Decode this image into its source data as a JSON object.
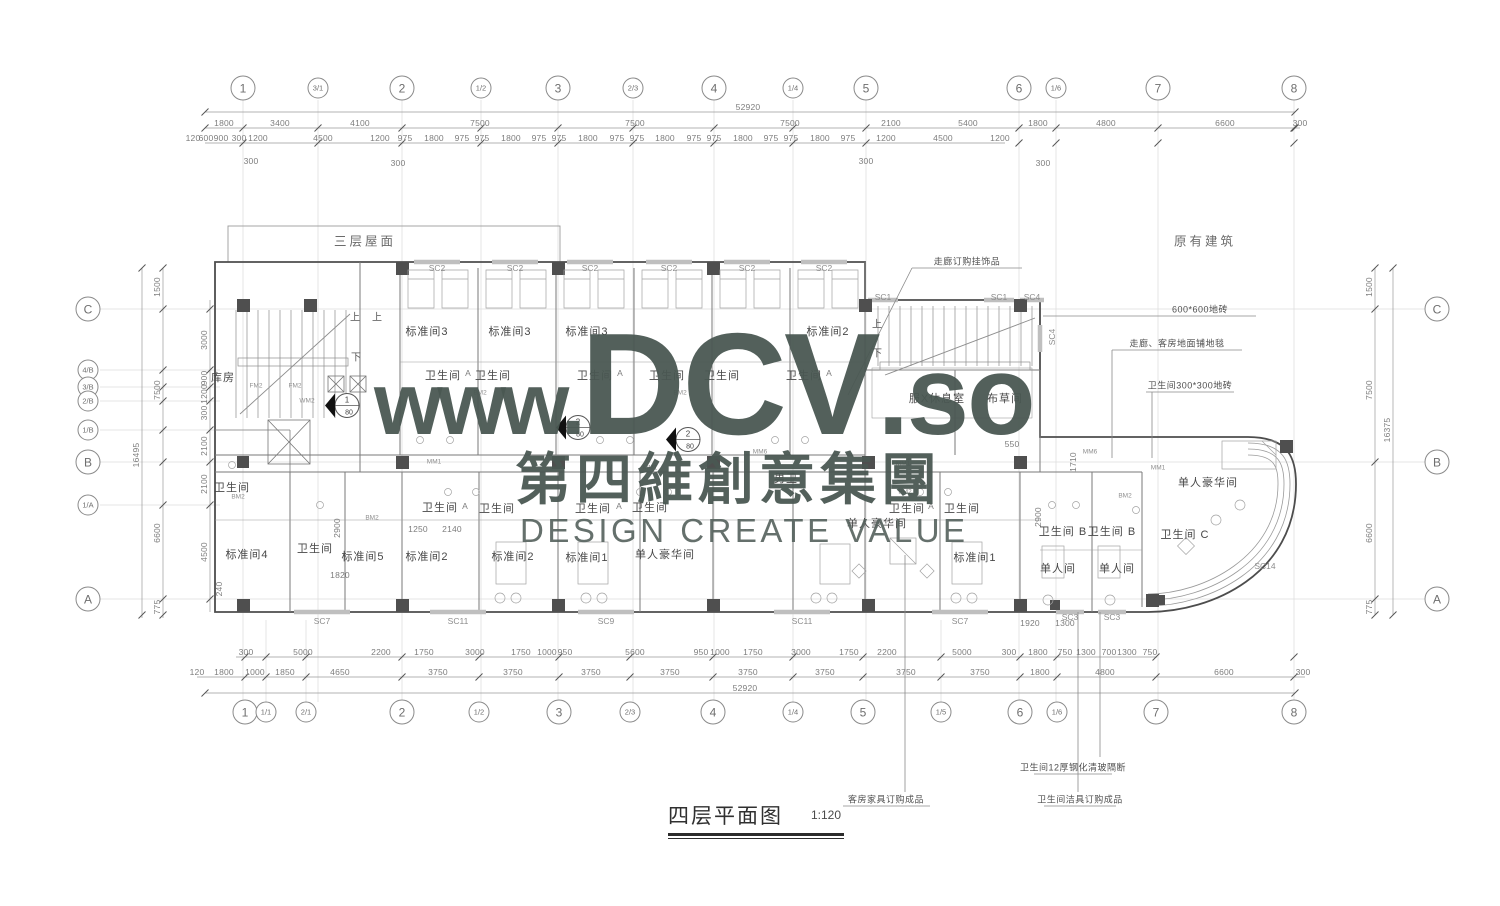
{
  "watermark": {
    "www": "www.",
    "brand": "DCV",
    "so": ".so",
    "cn": "第四維創意集團",
    "en": "DESIGN CREATE VALUE",
    "color": "#4a5752"
  },
  "title": {
    "text": "四层平面图",
    "scale": "1:120"
  },
  "grid_bubbles": {
    "top": [
      {
        "t": "1",
        "x": 243
      },
      {
        "t": "3/1",
        "x": 318
      },
      {
        "t": "2",
        "x": 402
      },
      {
        "t": "1/2",
        "x": 481
      },
      {
        "t": "3",
        "x": 558
      },
      {
        "t": "2/3",
        "x": 633
      },
      {
        "t": "4",
        "x": 714
      },
      {
        "t": "1/4",
        "x": 793
      },
      {
        "t": "5",
        "x": 866
      },
      {
        "t": "6",
        "x": 1019
      },
      {
        "t": "1/6",
        "x": 1056
      },
      {
        "t": "7",
        "x": 1158
      },
      {
        "t": "8",
        "x": 1294
      }
    ],
    "bottom": [
      {
        "t": "1",
        "x": 245
      },
      {
        "t": "1/1",
        "x": 266
      },
      {
        "t": "2/1",
        "x": 306
      },
      {
        "t": "2",
        "x": 402
      },
      {
        "t": "1/2",
        "x": 479
      },
      {
        "t": "3",
        "x": 559
      },
      {
        "t": "2/3",
        "x": 630
      },
      {
        "t": "4",
        "x": 713
      },
      {
        "t": "1/4",
        "x": 793
      },
      {
        "t": "5",
        "x": 863
      },
      {
        "t": "1/5",
        "x": 941
      },
      {
        "t": "6",
        "x": 1020
      },
      {
        "t": "1/6",
        "x": 1057
      },
      {
        "t": "7",
        "x": 1156
      },
      {
        "t": "8",
        "x": 1294
      }
    ],
    "left": [
      {
        "t": "C",
        "y": 309
      },
      {
        "t": "4/B",
        "y": 370
      },
      {
        "t": "3/B",
        "y": 387
      },
      {
        "t": "2/B",
        "y": 401
      },
      {
        "t": "1/B",
        "y": 430
      },
      {
        "t": "B",
        "y": 462
      },
      {
        "t": "1/A",
        "y": 505
      },
      {
        "t": "A",
        "y": 599
      }
    ],
    "right": [
      {
        "t": "C",
        "y": 309
      },
      {
        "t": "B",
        "y": 462
      },
      {
        "t": "A",
        "y": 599
      }
    ]
  },
  "dims": {
    "top_rows": [
      {
        "y": 107,
        "items": [
          {
            "t": "52920",
            "x": 748
          }
        ]
      },
      {
        "y": 123,
        "items": [
          {
            "t": "1800",
            "x": 224
          },
          {
            "t": "3400",
            "x": 280
          },
          {
            "t": "4100",
            "x": 360
          },
          {
            "t": "7500",
            "x": 480
          },
          {
            "t": "7500",
            "x": 635
          },
          {
            "t": "7500",
            "x": 790
          },
          {
            "t": "2100",
            "x": 891
          },
          {
            "t": "5400",
            "x": 968
          },
          {
            "t": "1800",
            "x": 1038
          },
          {
            "t": "4800",
            "x": 1106
          },
          {
            "t": "6600",
            "x": 1225
          },
          {
            "t": "300",
            "x": 1300
          }
        ]
      },
      {
        "y": 138,
        "items": [
          {
            "t": "120",
            "x": 193
          },
          {
            "t": "600",
            "x": 206
          },
          {
            "t": "900",
            "x": 221
          },
          {
            "t": "300",
            "x": 239
          },
          {
            "t": "1200",
            "x": 258
          },
          {
            "t": "4500",
            "x": 323
          },
          {
            "t": "1200",
            "x": 380
          },
          {
            "t": "975",
            "x": 405
          },
          {
            "t": "1800",
            "x": 434
          },
          {
            "t": "975",
            "x": 462
          },
          {
            "t": "975",
            "x": 482
          },
          {
            "t": "1800",
            "x": 511
          },
          {
            "t": "975",
            "x": 539
          },
          {
            "t": "975",
            "x": 559
          },
          {
            "t": "1800",
            "x": 588
          },
          {
            "t": "975",
            "x": 617
          },
          {
            "t": "975",
            "x": 637
          },
          {
            "t": "1800",
            "x": 665
          },
          {
            "t": "975",
            "x": 694
          },
          {
            "t": "975",
            "x": 714
          },
          {
            "t": "1800",
            "x": 743
          },
          {
            "t": "975",
            "x": 771
          },
          {
            "t": "975",
            "x": 791
          },
          {
            "t": "1800",
            "x": 820
          },
          {
            "t": "975",
            "x": 848
          },
          {
            "t": "1200",
            "x": 886
          },
          {
            "t": "4500",
            "x": 943
          },
          {
            "t": "1200",
            "x": 1000
          }
        ]
      }
    ],
    "top_drops": [
      {
        "t": "300",
        "x": 251,
        "y": 161
      },
      {
        "t": "300",
        "x": 398,
        "y": 163
      },
      {
        "t": "300",
        "x": 866,
        "y": 161
      },
      {
        "t": "300",
        "x": 1043,
        "y": 163
      }
    ],
    "bottom_rows": [
      {
        "y": 652,
        "items": [
          {
            "t": "300",
            "x": 246
          },
          {
            "t": "5000",
            "x": 303
          },
          {
            "t": "2200",
            "x": 381
          },
          {
            "t": "1750",
            "x": 424
          },
          {
            "t": "3000",
            "x": 475
          },
          {
            "t": "1750",
            "x": 521
          },
          {
            "t": "1000",
            "x": 547
          },
          {
            "t": "950",
            "x": 565
          },
          {
            "t": "5600",
            "x": 635
          },
          {
            "t": "950",
            "x": 701
          },
          {
            "t": "1000",
            "x": 720
          },
          {
            "t": "1750",
            "x": 753
          },
          {
            "t": "3000",
            "x": 801
          },
          {
            "t": "1750",
            "x": 849
          },
          {
            "t": "2200",
            "x": 887
          },
          {
            "t": "5000",
            "x": 962
          },
          {
            "t": "300",
            "x": 1009
          },
          {
            "t": "1800",
            "x": 1038
          },
          {
            "t": "750",
            "x": 1065
          },
          {
            "t": "1300",
            "x": 1086
          },
          {
            "t": "700",
            "x": 1109
          },
          {
            "t": "1300",
            "x": 1127
          },
          {
            "t": "750",
            "x": 1150
          }
        ]
      },
      {
        "y": 672,
        "items": [
          {
            "t": "120",
            "x": 197
          },
          {
            "t": "1800",
            "x": 224
          },
          {
            "t": "1000",
            "x": 255
          },
          {
            "t": "1850",
            "x": 285
          },
          {
            "t": "4650",
            "x": 340
          },
          {
            "t": "3750",
            "x": 438
          },
          {
            "t": "3750",
            "x": 513
          },
          {
            "t": "3750",
            "x": 591
          },
          {
            "t": "3750",
            "x": 670
          },
          {
            "t": "3750",
            "x": 748
          },
          {
            "t": "3750",
            "x": 825
          },
          {
            "t": "3750",
            "x": 906
          },
          {
            "t": "3750",
            "x": 980
          },
          {
            "t": "1800",
            "x": 1040
          },
          {
            "t": "4800",
            "x": 1105
          },
          {
            "t": "6600",
            "x": 1224
          },
          {
            "t": "300",
            "x": 1303
          }
        ]
      },
      {
        "y": 688,
        "items": [
          {
            "t": "52920",
            "x": 745
          }
        ]
      }
    ],
    "left_rows": [
      {
        "x": 136,
        "items": [
          {
            "t": "16495",
            "y": 455
          }
        ]
      },
      {
        "x": 157,
        "items": [
          {
            "t": "1500",
            "y": 287
          },
          {
            "t": "7500",
            "y": 390
          },
          {
            "t": "6600",
            "y": 533
          },
          {
            "t": "775",
            "y": 607
          }
        ]
      },
      {
        "x": 204,
        "items": [
          {
            "t": "3000",
            "y": 340
          },
          {
            "t": "900",
            "y": 378
          },
          {
            "t": "1200",
            "y": 394
          },
          {
            "t": "300",
            "y": 413
          },
          {
            "t": "2100",
            "y": 446
          },
          {
            "t": "2100",
            "y": 484
          },
          {
            "t": "4500",
            "y": 552
          }
        ]
      }
    ],
    "right_rows": [
      {
        "x": 1369,
        "items": [
          {
            "t": "1500",
            "y": 287
          },
          {
            "t": "7500",
            "y": 390
          },
          {
            "t": "6600",
            "y": 533
          },
          {
            "t": "775",
            "y": 607
          }
        ]
      },
      {
        "x": 1387,
        "items": [
          {
            "t": "16375",
            "y": 430
          }
        ]
      }
    ],
    "plan_dims": [
      {
        "t": "1820",
        "x": 340,
        "y": 575
      },
      {
        "t": "2900",
        "x": 337,
        "y": 528,
        "r": 1
      },
      {
        "t": "1250",
        "x": 418,
        "y": 529
      },
      {
        "t": "2140",
        "x": 452,
        "y": 529
      },
      {
        "t": "550",
        "x": 1012,
        "y": 444
      },
      {
        "t": "1710",
        "x": 1073,
        "y": 462,
        "r": 1
      },
      {
        "t": "2900",
        "x": 1038,
        "y": 517,
        "r": 1
      },
      {
        "t": "1920",
        "x": 1030,
        "y": 623
      },
      {
        "t": "1300",
        "x": 1065,
        "y": 623
      },
      {
        "t": "240",
        "x": 219,
        "y": 589,
        "r": 1
      }
    ]
  },
  "rooms": [
    {
      "t": "库房",
      "x": 223,
      "y": 377
    },
    {
      "t": "标准间3",
      "x": 427,
      "y": 331
    },
    {
      "t": "标准间3",
      "x": 510,
      "y": 331
    },
    {
      "t": "标准间3",
      "x": 587,
      "y": 331
    },
    {
      "t": "标准间2",
      "x": 828,
      "y": 331
    },
    {
      "t": "标准间4",
      "x": 247,
      "y": 554
    },
    {
      "t": "标准间5",
      "x": 363,
      "y": 556
    },
    {
      "t": "标准间2",
      "x": 427,
      "y": 556
    },
    {
      "t": "标准间2",
      "x": 513,
      "y": 556
    },
    {
      "t": "标准间1",
      "x": 587,
      "y": 557
    },
    {
      "t": "标准间1",
      "x": 975,
      "y": 557
    },
    {
      "t": "单人豪华间",
      "x": 665,
      "y": 554
    },
    {
      "t": "单人豪华间",
      "x": 877,
      "y": 523
    },
    {
      "t": "单人豪华间",
      "x": 1208,
      "y": 482
    },
    {
      "t": "单人间",
      "x": 1058,
      "y": 568
    },
    {
      "t": "单人间",
      "x": 1117,
      "y": 568
    },
    {
      "t": "服X休息室",
      "x": 937,
      "y": 398
    },
    {
      "t": "布草间",
      "x": 1005,
      "y": 398
    },
    {
      "t": "男卫",
      "x": 786,
      "y": 478
    }
  ],
  "bathrooms": [
    {
      "t": "卫生间",
      "x": 232,
      "y": 487
    },
    {
      "t": "卫生间",
      "x": 315,
      "y": 548
    },
    {
      "t": "卫生间",
      "x": 443,
      "y": 375
    },
    {
      "t": "卫生间",
      "x": 493,
      "y": 375
    },
    {
      "t": "卫生间",
      "x": 595,
      "y": 375
    },
    {
      "t": "卫生间",
      "x": 667,
      "y": 375
    },
    {
      "t": "卫生间",
      "x": 722,
      "y": 375
    },
    {
      "t": "卫生间",
      "x": 804,
      "y": 375
    },
    {
      "t": "卫生间",
      "x": 440,
      "y": 507
    },
    {
      "t": "卫生间",
      "x": 497,
      "y": 508
    },
    {
      "t": "卫生间",
      "x": 593,
      "y": 508
    },
    {
      "t": "卫生间",
      "x": 650,
      "y": 507
    },
    {
      "t": "卫生间",
      "x": 907,
      "y": 508
    },
    {
      "t": "卫生间",
      "x": 962,
      "y": 508
    },
    {
      "t": "卫生间 B",
      "x": 1063,
      "y": 531
    },
    {
      "t": "卫生间 B",
      "x": 1112,
      "y": 531
    },
    {
      "t": "卫生间 C",
      "x": 1185,
      "y": 534
    }
  ],
  "bath_letters": [
    {
      "t": "A",
      "x": 468,
      "y": 373
    },
    {
      "t": "A",
      "x": 620,
      "y": 373
    },
    {
      "t": "A",
      "x": 829,
      "y": 373
    },
    {
      "t": "A",
      "x": 465,
      "y": 506
    },
    {
      "t": "A",
      "x": 619,
      "y": 506
    },
    {
      "t": "A",
      "x": 931,
      "y": 506
    }
  ],
  "area_labels": [
    {
      "t": "三层屋面",
      "x": 365,
      "y": 240
    },
    {
      "t": "原有建筑",
      "x": 1205,
      "y": 240
    }
  ],
  "window_tags": [
    {
      "t": "SC2",
      "x": 437,
      "y": 268
    },
    {
      "t": "SC2",
      "x": 515,
      "y": 268
    },
    {
      "t": "SC2",
      "x": 590,
      "y": 268
    },
    {
      "t": "SC2",
      "x": 669,
      "y": 268
    },
    {
      "t": "SC2",
      "x": 747,
      "y": 268
    },
    {
      "t": "SC2",
      "x": 824,
      "y": 268
    },
    {
      "t": "SC1",
      "x": 883,
      "y": 297
    },
    {
      "t": "SC1",
      "x": 999,
      "y": 297
    },
    {
      "t": "SC4",
      "x": 1032,
      "y": 297
    },
    {
      "t": "SC4",
      "x": 1052,
      "y": 337,
      "r": 1
    },
    {
      "t": "SC7",
      "x": 322,
      "y": 621
    },
    {
      "t": "SC11",
      "x": 458,
      "y": 621
    },
    {
      "t": "SC9",
      "x": 606,
      "y": 621
    },
    {
      "t": "SC11",
      "x": 802,
      "y": 621
    },
    {
      "t": "SC7",
      "x": 960,
      "y": 621
    },
    {
      "t": "SC3",
      "x": 1070,
      "y": 617
    },
    {
      "t": "SC3",
      "x": 1112,
      "y": 617
    },
    {
      "t": "SC14",
      "x": 1265,
      "y": 566
    }
  ],
  "door_tags": [
    {
      "t": "FM2",
      "x": 256,
      "y": 386
    },
    {
      "t": "FM2",
      "x": 295,
      "y": 386
    },
    {
      "t": "WM2",
      "x": 307,
      "y": 401
    },
    {
      "t": "BM2",
      "x": 238,
      "y": 497
    },
    {
      "t": "BM2",
      "x": 372,
      "y": 518
    },
    {
      "t": "BM2",
      "x": 480,
      "y": 393
    },
    {
      "t": "BM2",
      "x": 680,
      "y": 393
    },
    {
      "t": "BM2",
      "x": 905,
      "y": 492
    },
    {
      "t": "BM2",
      "x": 1125,
      "y": 496
    },
    {
      "t": "MM1",
      "x": 434,
      "y": 462
    },
    {
      "t": "MM1",
      "x": 650,
      "y": 468
    },
    {
      "t": "MM1",
      "x": 903,
      "y": 464
    },
    {
      "t": "MM1",
      "x": 1158,
      "y": 468
    },
    {
      "t": "MM6",
      "x": 760,
      "y": 452
    },
    {
      "t": "MM6",
      "x": 1090,
      "y": 452
    }
  ],
  "stair_labels": [
    {
      "t": "上",
      "x": 355,
      "y": 316
    },
    {
      "t": "上",
      "x": 377,
      "y": 316
    },
    {
      "t": "下",
      "x": 356,
      "y": 356
    },
    {
      "t": "上",
      "x": 877,
      "y": 323
    },
    {
      "t": "下",
      "x": 877,
      "y": 352
    }
  ],
  "section_markers": [
    {
      "num": "1",
      "scale": "80",
      "x": 345,
      "y": 408
    },
    {
      "num": "2",
      "scale": "80",
      "x": 576,
      "y": 430
    },
    {
      "num": "2",
      "scale": "80",
      "x": 686,
      "y": 442
    }
  ],
  "annotations": [
    {
      "t": "走廊订购挂饰品",
      "x": 967,
      "y": 261
    },
    {
      "t": "600*600地砖",
      "x": 1200,
      "y": 309
    },
    {
      "t": "走廊、客房地面铺地毯",
      "x": 1177,
      "y": 343
    },
    {
      "t": "卫生间300*300地砖",
      "x": 1190,
      "y": 385
    },
    {
      "t": "客房家具订购成品",
      "x": 886,
      "y": 799
    },
    {
      "t": "卫生间12厚钢化清玻隔断",
      "x": 1073,
      "y": 767
    },
    {
      "t": "卫生间洁具订购成品",
      "x": 1080,
      "y": 799
    }
  ]
}
